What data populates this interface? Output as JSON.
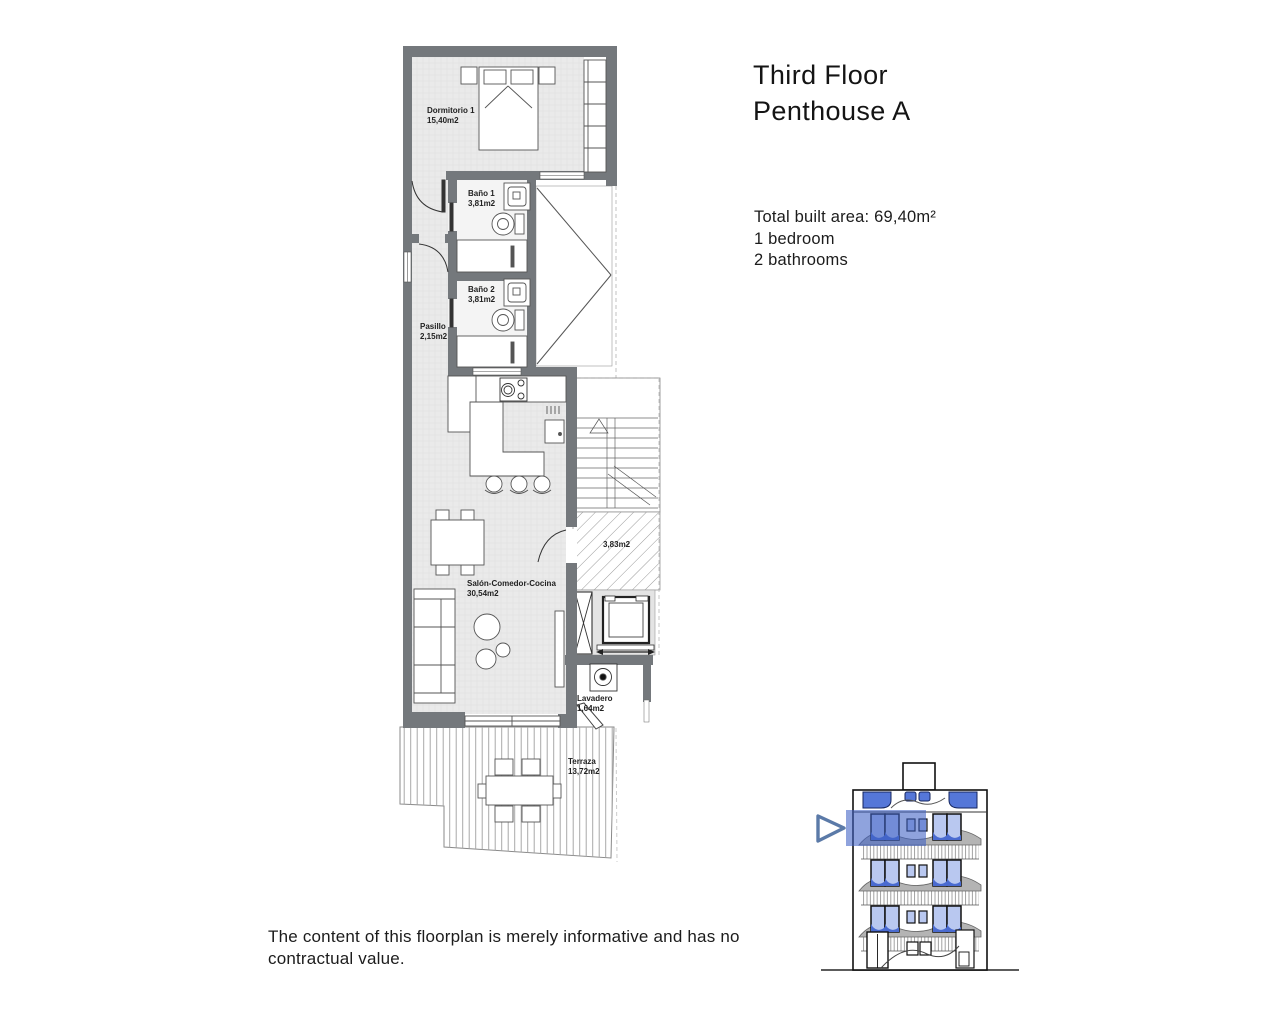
{
  "page": {
    "background": "#ffffff"
  },
  "header": {
    "title_line1": "Third Floor",
    "title_line2": "Penthouse A"
  },
  "summary": {
    "total_built_area": "Total built area: 69,40m²",
    "bedrooms": "1 bedroom",
    "bathrooms": "2 bathrooms"
  },
  "floorplan": {
    "rooms": [
      {
        "name": "Dormitorio 1",
        "area": "15,40m2"
      },
      {
        "name": "Baño 1",
        "area": "3,81m2"
      },
      {
        "name": "Baño 2",
        "area": "3,81m2"
      },
      {
        "name": "Pasillo",
        "area": "2,15m2"
      },
      {
        "name": "Salón-Comedor-Cocina",
        "area": "30,54m2"
      },
      {
        "name": "Lavadero",
        "area": "1,64m2"
      },
      {
        "name": "Terraza",
        "area": "13,72m2"
      }
    ],
    "stair_area": {
      "area": "3,83m2"
    }
  },
  "elevation": {
    "highlighted_floor": "third"
  },
  "disclaimer": "The content of this floorplan is merely informative and has no contractual value.",
  "colors": {
    "highlight_blue": "#3e61c5",
    "window_blue": "#b9c8f0",
    "glass_dark_blue": "#4a6bd0",
    "balcony_gray": "#b4b4b4",
    "wall_gray": "#74787c",
    "floor_gray": "#eaeaea",
    "arrow_blue": "#5b7aa8"
  }
}
